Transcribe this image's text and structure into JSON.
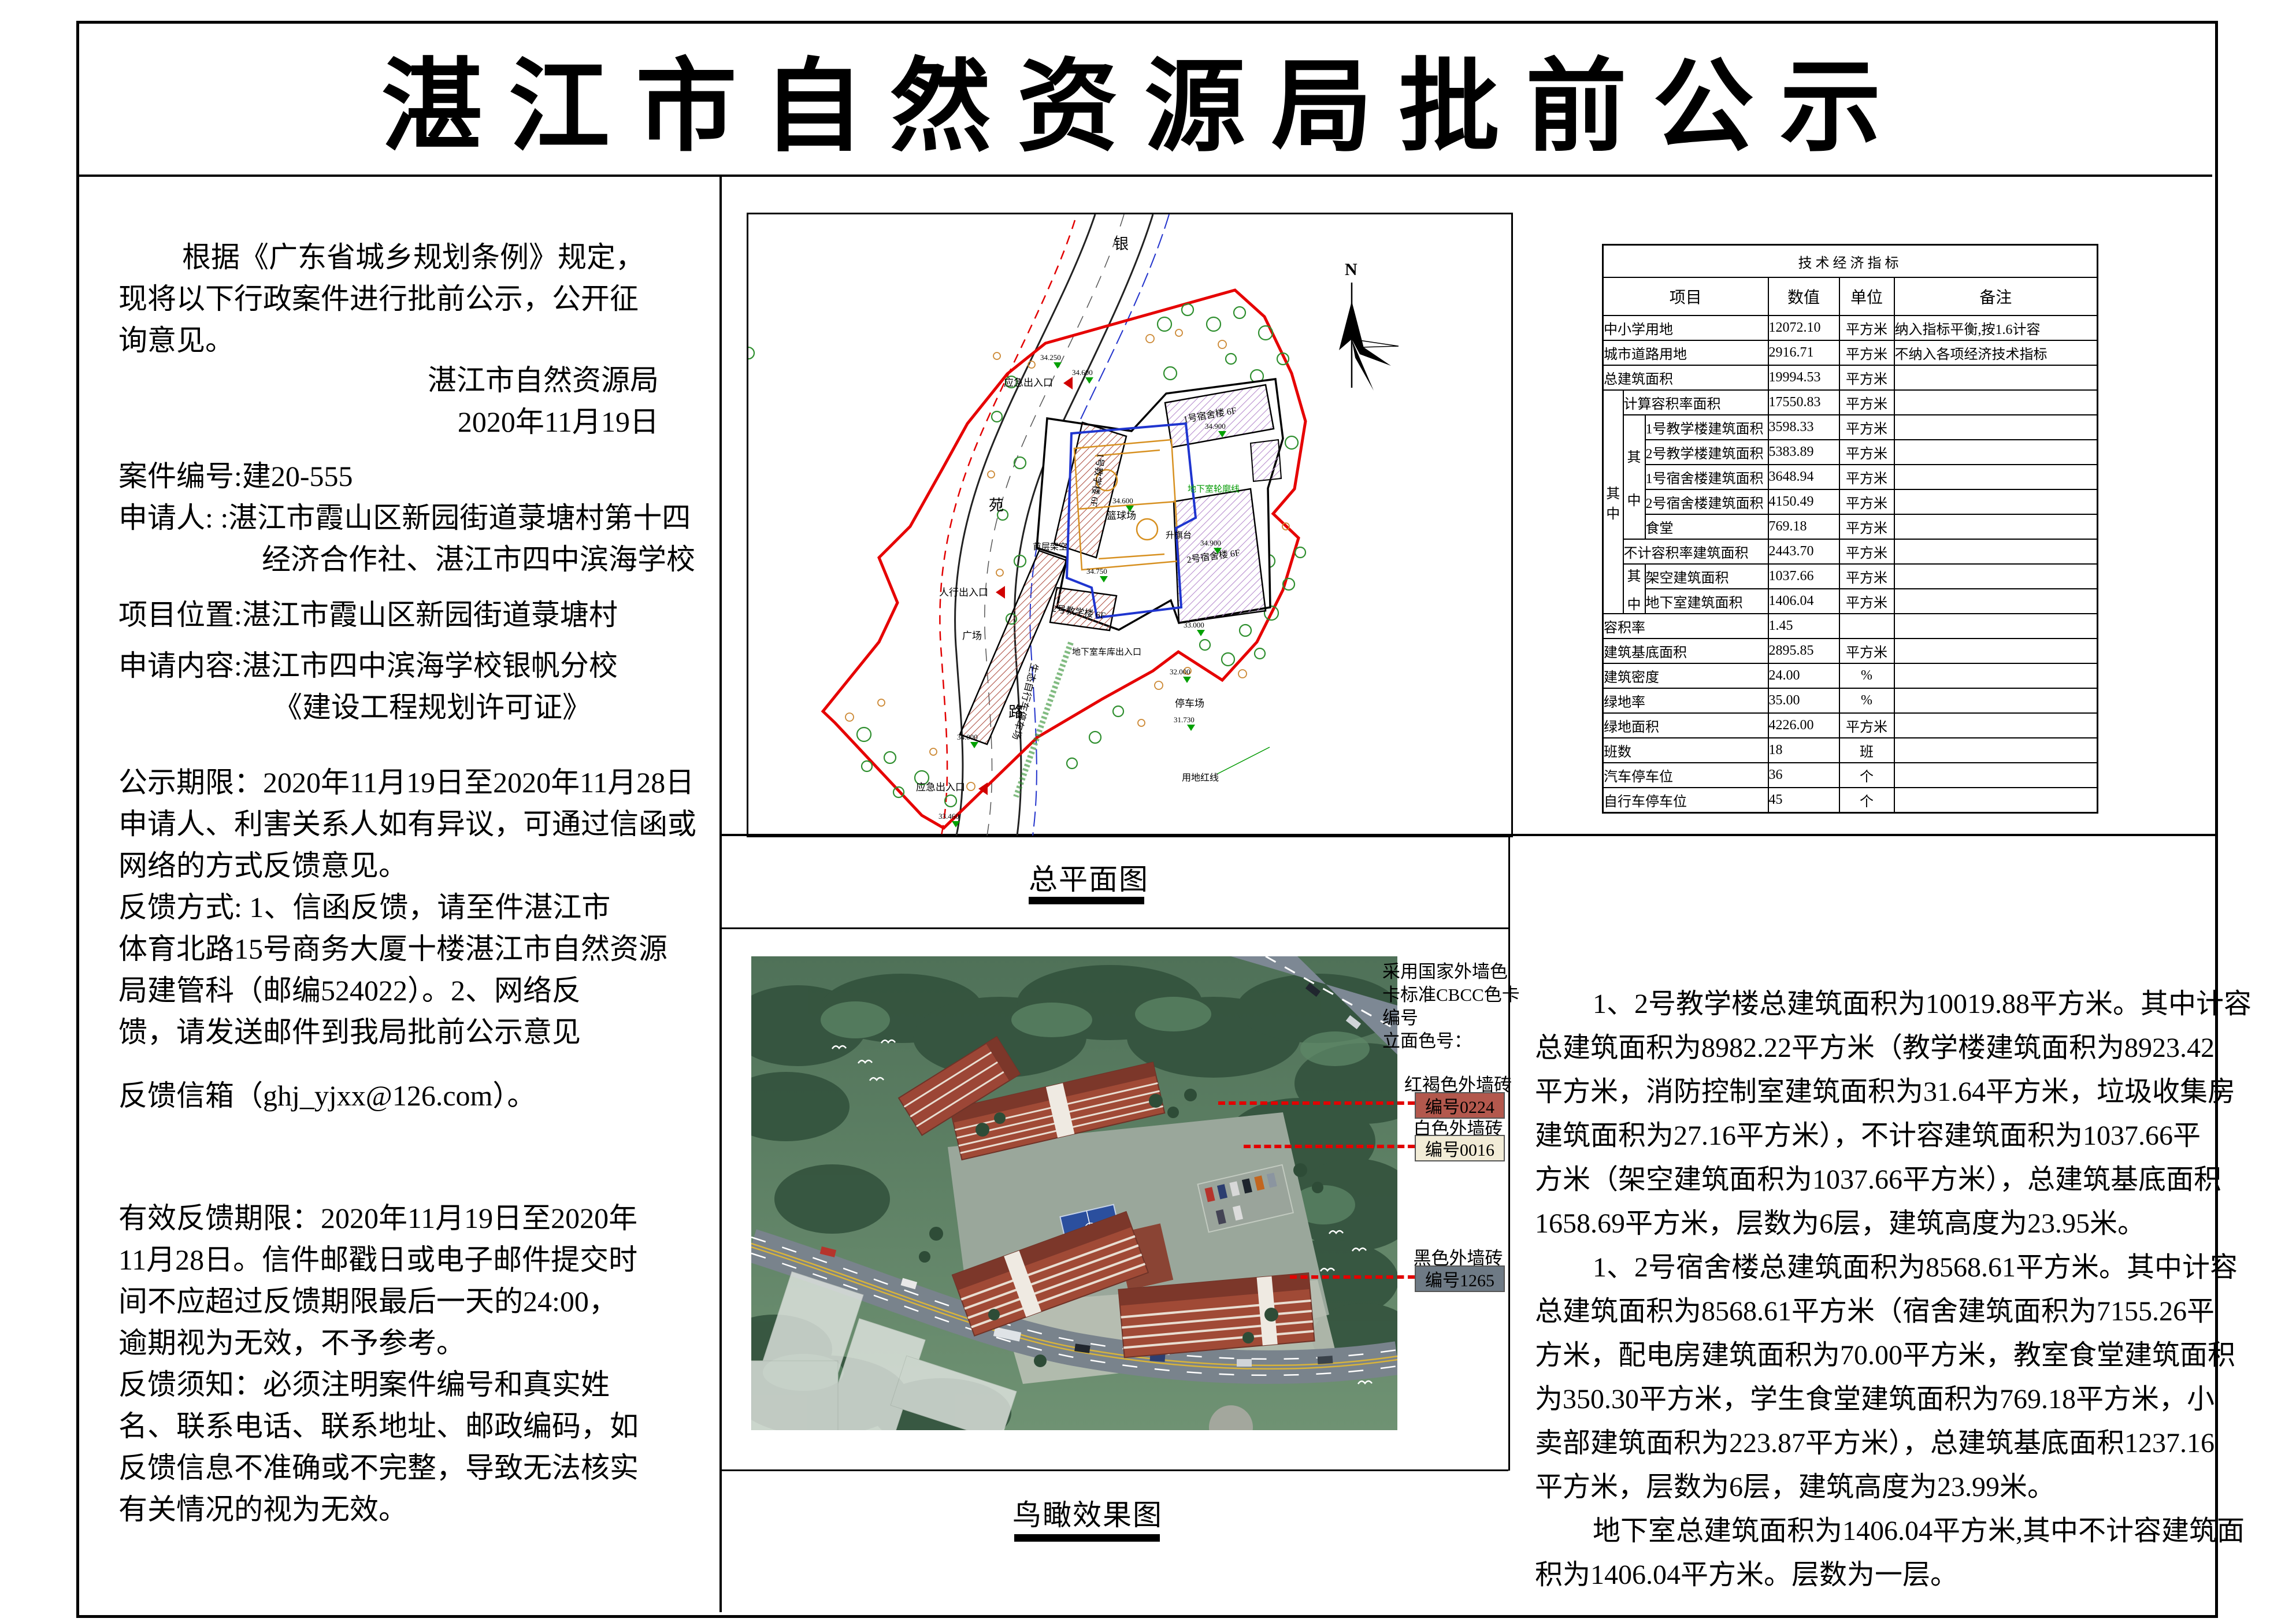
{
  "doc": {
    "title": "湛江市自然资源局批前公示"
  },
  "left_panel": {
    "intro_lines": [
      "根据《广东省城乡规划条例》规定，",
      "现将以下行政案件进行批前公示，公开征",
      "询意见。"
    ],
    "signature_lines": [
      "湛江市自然资源局",
      "2020年11月19日"
    ],
    "case_lines": [
      "案件编号:建20-555",
      "申请人: :湛江市霞山区新园街道菉塘村第十四",
      "经济合作社、湛江市四中滨海学校",
      "项目位置:湛江市霞山区新园街道菉塘村",
      "申请内容:湛江市四中滨海学校银帆分校",
      "《建设工程规划许可证》"
    ],
    "notice_lines": [
      "公示期限：2020年11月19日至2020年11月28日",
      "申请人、利害关系人如有异议，可通过信函或",
      "网络的方式反馈意见。",
      "反馈方式: 1、信函反馈，请至件湛江市",
      "体育北路15号商务大厦十楼湛江市自然资源",
      "局建管科（邮编524022）。2、网络反",
      "馈，请发送邮件到我局批前公示意见"
    ],
    "mailbox_line": "反馈信箱（ghj_yjxx@126.com）。",
    "deadline_lines": [
      "有效反馈期限：2020年11月19日至2020年",
      "11月28日。信件邮戳日或电子邮件提交时",
      "间不应超过反馈期限最后一天的24:00，",
      "逾期视为无效，不予参考。",
      "反馈须知：必须注明案件编号和真实姓",
      "名、联系电话、联系地址、邮政编码，如",
      "反馈信息不准确或不完整，导致无法核实",
      "有关情况的视为无效。"
    ]
  },
  "site_plan": {
    "caption": "总平面图",
    "north_label": "N",
    "road_chars": [
      "银",
      "苑",
      "路"
    ],
    "labels": {
      "emergency_exit_top": "应急出入口",
      "emergency_exit_bottom": "应急出入口",
      "pedestrian_entry": "人行出入口",
      "plaza": "广场",
      "bike_parking": "生态自行车停车场",
      "basement_entry": "地下室车库出入口",
      "parking": "停车场",
      "red_line": "用地红线",
      "basketball": "篮球场",
      "flag_stage": "升旗台",
      "ground_void": "首层架空",
      "basement_outline": "地下室轮廓线"
    },
    "buildings": {
      "teach1": "1号教学楼 6F",
      "teach2": "2号教学楼 6F",
      "dorm1": "1号宿舍楼 6F",
      "dorm2": "2号宿舍楼 6F"
    },
    "elevations": [
      "34.250",
      "34.600",
      "34.600",
      "34.900",
      "34.900",
      "33.000",
      "32.000",
      "34.000",
      "33.460",
      "31.730",
      "34.750"
    ]
  },
  "table": {
    "title": "技术经济指标",
    "headers": [
      "项目",
      "数值",
      "单位",
      "备注"
    ],
    "group_char_top": "其",
    "group_char_bottom": "中",
    "rows": [
      {
        "item": "中小学用地",
        "value": "12072.10",
        "unit": "平方米",
        "note": "纳入指标平衡,按1.6计容"
      },
      {
        "item": "城市道路用地",
        "value": "2916.71",
        "unit": "平方米",
        "note": "不纳入各项经济技术指标"
      },
      {
        "item": "总建筑面积",
        "value": "19994.53",
        "unit": "平方米",
        "note": ""
      },
      {
        "item": "计算容积率面积",
        "value": "17550.83",
        "unit": "平方米",
        "note": ""
      },
      {
        "item": "1号教学楼建筑面积",
        "value": "3598.33",
        "unit": "平方米",
        "note": ""
      },
      {
        "item": "2号教学楼建筑面积",
        "value": "5383.89",
        "unit": "平方米",
        "note": ""
      },
      {
        "item": "1号宿舍楼建筑面积",
        "value": "3648.94",
        "unit": "平方米",
        "note": ""
      },
      {
        "item": "2号宿舍楼建筑面积",
        "value": "4150.49",
        "unit": "平方米",
        "note": ""
      },
      {
        "item": "食堂",
        "value": "769.18",
        "unit": "平方米",
        "note": ""
      },
      {
        "item": "不计容积率建筑面积",
        "value": "2443.70",
        "unit": "平方米",
        "note": ""
      },
      {
        "item": "架空建筑面积",
        "value": "1037.66",
        "unit": "平方米",
        "note": ""
      },
      {
        "item": "地下室建筑面积",
        "value": "1406.04",
        "unit": "平方米",
        "note": ""
      },
      {
        "item": "容积率",
        "value": "1.45",
        "unit": "",
        "note": ""
      },
      {
        "item": "建筑基底面积",
        "value": "2895.85",
        "unit": "平方米",
        "note": ""
      },
      {
        "item": "建筑密度",
        "value": "24.00",
        "unit": "%",
        "note": ""
      },
      {
        "item": "绿地率",
        "value": "35.00",
        "unit": "%",
        "note": ""
      },
      {
        "item": "绿地面积",
        "value": "4226.00",
        "unit": "平方米",
        "note": ""
      },
      {
        "item": "班数",
        "value": "18",
        "unit": "班",
        "note": ""
      },
      {
        "item": "汽车停车位",
        "value": "36",
        "unit": "个",
        "note": ""
      },
      {
        "item": "自行车停车位",
        "value": "45",
        "unit": "个",
        "note": ""
      }
    ]
  },
  "render_view": {
    "caption": "鸟瞰效果图",
    "annotation_lines": [
      "采用国家外墙色",
      "卡标准CBCC色卡",
      "编号",
      "立面色号："
    ],
    "swatches": [
      {
        "label": "红褐色外墙砖",
        "code": "编号0224",
        "color": "#b3584d"
      },
      {
        "label": "白色外墙砖",
        "code": "编号0016",
        "color": "#f2ecd7"
      },
      {
        "label": "黑色外墙砖",
        "code": "编号1265",
        "color": "#6e7a85"
      }
    ]
  },
  "description": {
    "lines": [
      {
        "text": "1、2号教学楼总建筑面积为10019.88平方米。其中计容",
        "indent": true
      },
      {
        "text": "总建筑面积为8982.22平方米（教学楼建筑面积为8923.42",
        "indent": false
      },
      {
        "text": "平方米，消防控制室建筑面积为31.64平方米，垃圾收集房",
        "indent": false
      },
      {
        "text": "建筑面积为27.16平方米），不计容建筑面积为1037.66平",
        "indent": false
      },
      {
        "text": "方米（架空建筑面积为1037.66平方米），总建筑基底面积",
        "indent": false
      },
      {
        "text": "1658.69平方米，层数为6层，建筑高度为23.95米。",
        "indent": false
      },
      {
        "text": "1、2号宿舍楼总建筑面积为8568.61平方米。其中计容",
        "indent": true
      },
      {
        "text": "总建筑面积为8568.61平方米（宿舍建筑面积为7155.26平",
        "indent": false
      },
      {
        "text": "方米，配电房建筑面积为70.00平方米，教室食堂建筑面积",
        "indent": false
      },
      {
        "text": "为350.30平方米，学生食堂建筑面积为769.18平方米，小",
        "indent": false
      },
      {
        "text": "卖部建筑面积为223.87平方米），总建筑基底面积1237.16",
        "indent": false
      },
      {
        "text": "平方米，层数为6层，建筑高度为23.99米。",
        "indent": false
      },
      {
        "text": "地下室总建筑面积为1406.04平方米,其中不计容建筑面",
        "indent": true
      },
      {
        "text": "积为1406.04平方米。层数为一层。",
        "indent": false
      }
    ]
  }
}
